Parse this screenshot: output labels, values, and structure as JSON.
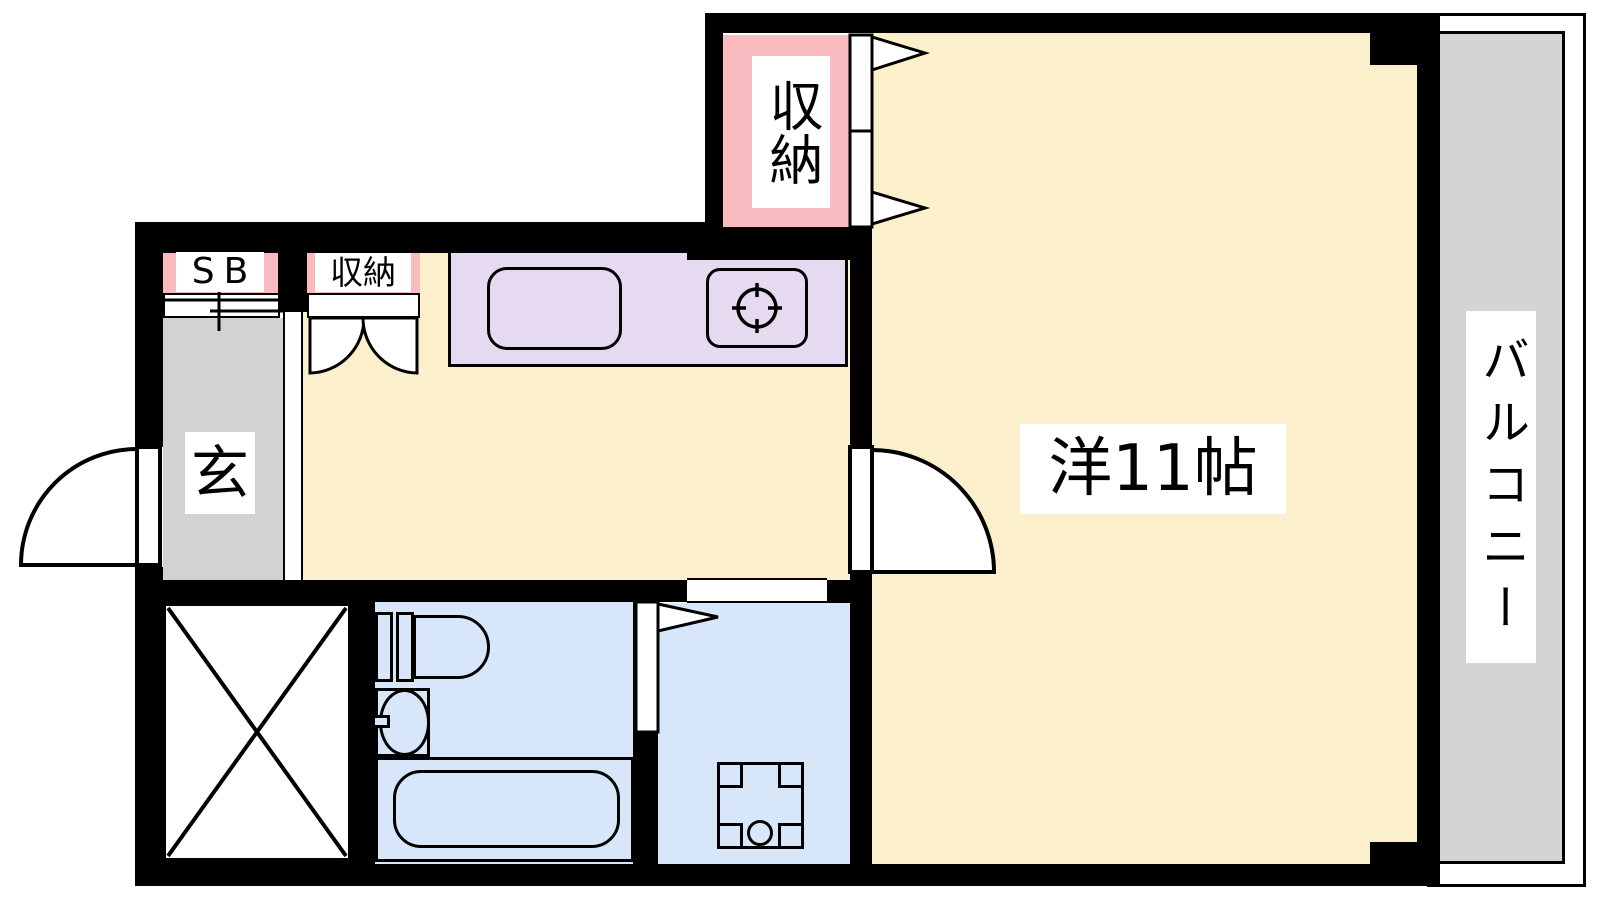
{
  "rooms": {
    "main_room": {
      "label": "洋11帖"
    },
    "balcony": {
      "label": "バルコニー"
    },
    "entrance": {
      "label": "玄"
    },
    "shoe_box": {
      "label": "SB"
    },
    "hall_closet": {
      "label": "収納"
    },
    "room_closet": {
      "label": "収納"
    }
  },
  "colors": {
    "floor_cream": "#FCEFCC",
    "closet_pink": "#F9BBBF",
    "kitchen_lavender": "#E6DAF1",
    "bath_blue": "#D7E6F8",
    "entrance_gray": "#D2D2D2",
    "balcony_gray": "#D4D4D4",
    "wall_black": "#000000"
  }
}
